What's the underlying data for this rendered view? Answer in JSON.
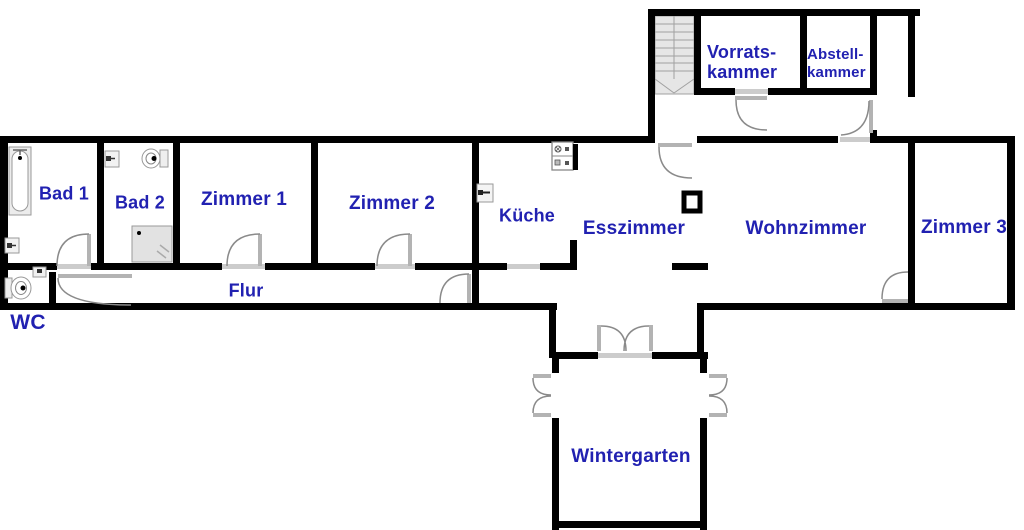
{
  "title": "Grundriss Wohnung (floor plan)",
  "colors": {
    "label_blue": "#2121b1",
    "wall_black": "#000000",
    "door_grey": "#8a8a8a",
    "leaf_grey": "#b3b3b3",
    "threshold_grey": "#cccccc",
    "fixture_grey": "#999999",
    "stair_fill": "#e6e6e6"
  },
  "rooms": {
    "bad1": {
      "label": "Bad 1"
    },
    "bad2": {
      "label": "Bad 2"
    },
    "zimmer1": {
      "label": "Zimmer 1"
    },
    "zimmer2": {
      "label": "Zimmer 2"
    },
    "kueche": {
      "label": "Küche"
    },
    "esszimmer": {
      "label": "Esszimmer"
    },
    "wohnzimmer": {
      "label": "Wohnzimmer"
    },
    "zimmer3": {
      "label": "Zimmer 3"
    },
    "flur": {
      "label": "Flur"
    },
    "wc": {
      "label": "WC"
    },
    "wintergarten": {
      "label": "Wintergarten"
    },
    "vorratskammer": {
      "line1": "Vorrats-",
      "line2": "kammer"
    },
    "abstellkammer": {
      "line1": "Abstell-",
      "line2": "kammer"
    }
  }
}
